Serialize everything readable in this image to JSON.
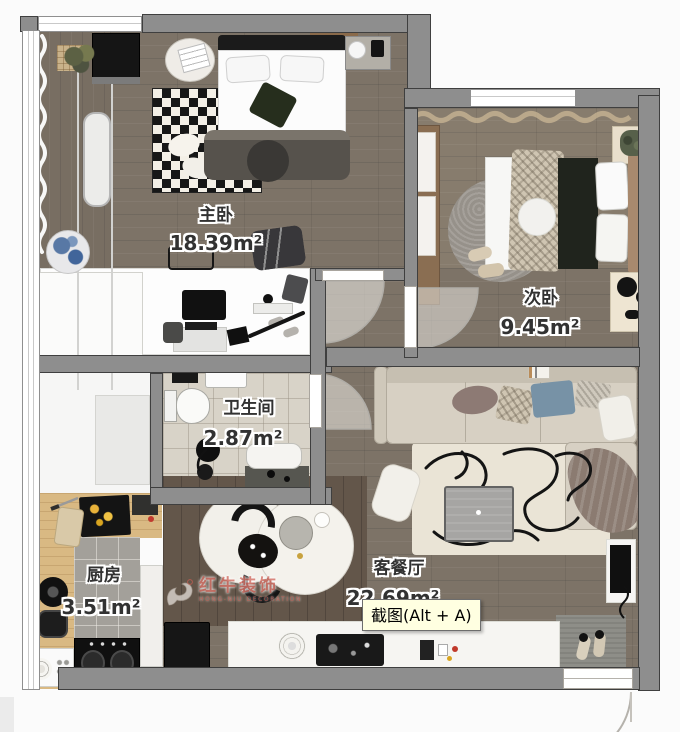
{
  "tooltip": {
    "text": "截图(Alt + A)"
  },
  "floorplan": {
    "rooms": [
      {
        "id": "master-bedroom",
        "name": "主卧",
        "area": "18.39m²"
      },
      {
        "id": "second-bedroom",
        "name": "次卧",
        "area": "9.45m²"
      },
      {
        "id": "bathroom",
        "name": "卫生间",
        "area": "2.87m²"
      },
      {
        "id": "kitchen",
        "name": "厨房",
        "area": "3.51m²"
      },
      {
        "id": "living-dining",
        "name": "客餐厅",
        "area": "22.69m²"
      }
    ],
    "watermark": {
      "brand": "红牛装饰",
      "subtitle": "HONG-NIU DECORATION",
      "icon": "bull-logo"
    }
  },
  "colors": {
    "wall": "#8e8e8e",
    "wall_edge": "#3f3f3f",
    "wood_floor": "#7d7367",
    "bath_tile": "#d8d3c8",
    "kitchen_tile": "#a3a09a",
    "tooltip_bg": "#ffffe1",
    "watermark_red": "#cd5f55",
    "label_text": "#323232"
  }
}
